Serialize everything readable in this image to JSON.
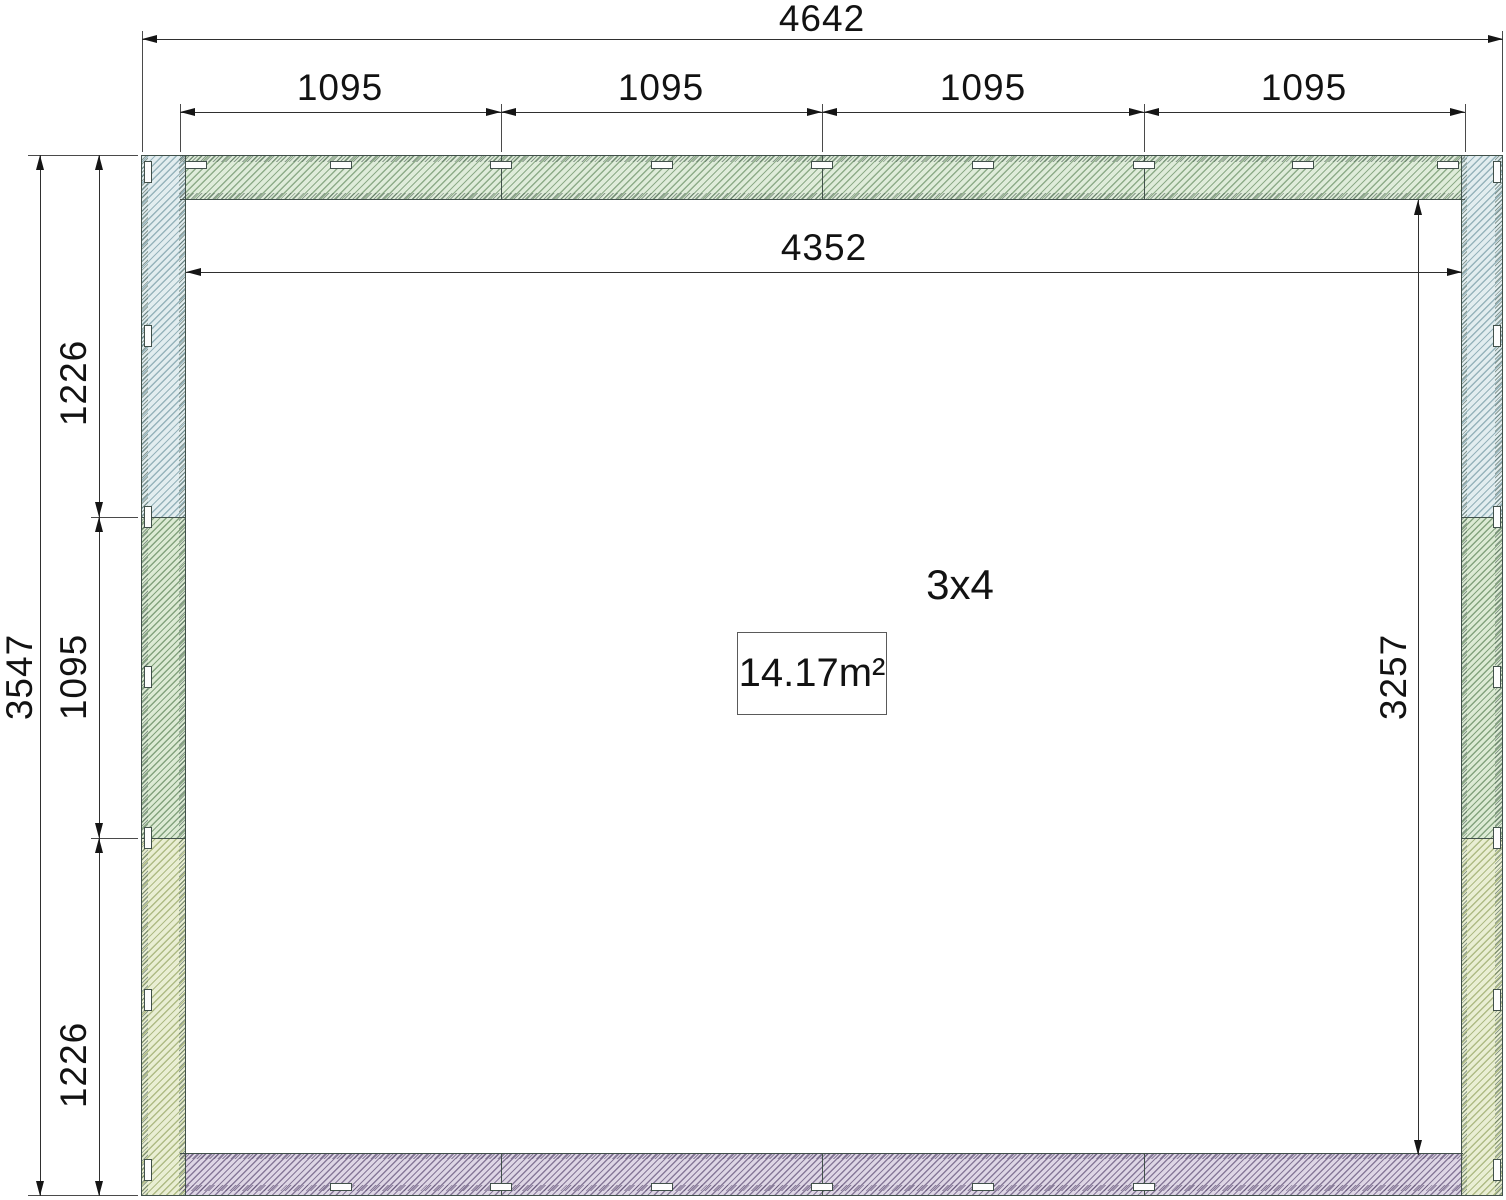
{
  "drawing": {
    "room_label": "3x4",
    "area_label": "14.17m²",
    "dims": {
      "overall_width": "4642",
      "top_segments": [
        "1095",
        "1095",
        "1095",
        "1095"
      ],
      "inner_width": "4352",
      "overall_height": "3547",
      "left_top": "1226",
      "left_mid": "1095",
      "left_bottom": "1226",
      "inner_height": "3257"
    },
    "colors": {
      "wall_blue": "#e2edef",
      "wall_green": "#dcead4",
      "wall_top_green": "#dfecda",
      "wall_yellow": "#e9eed3",
      "wall_purple": "#ded6e5",
      "outline": "#41504a",
      "dimension_line": "#2f2f2f",
      "text": "#121212",
      "background": "#ffffff"
    }
  }
}
